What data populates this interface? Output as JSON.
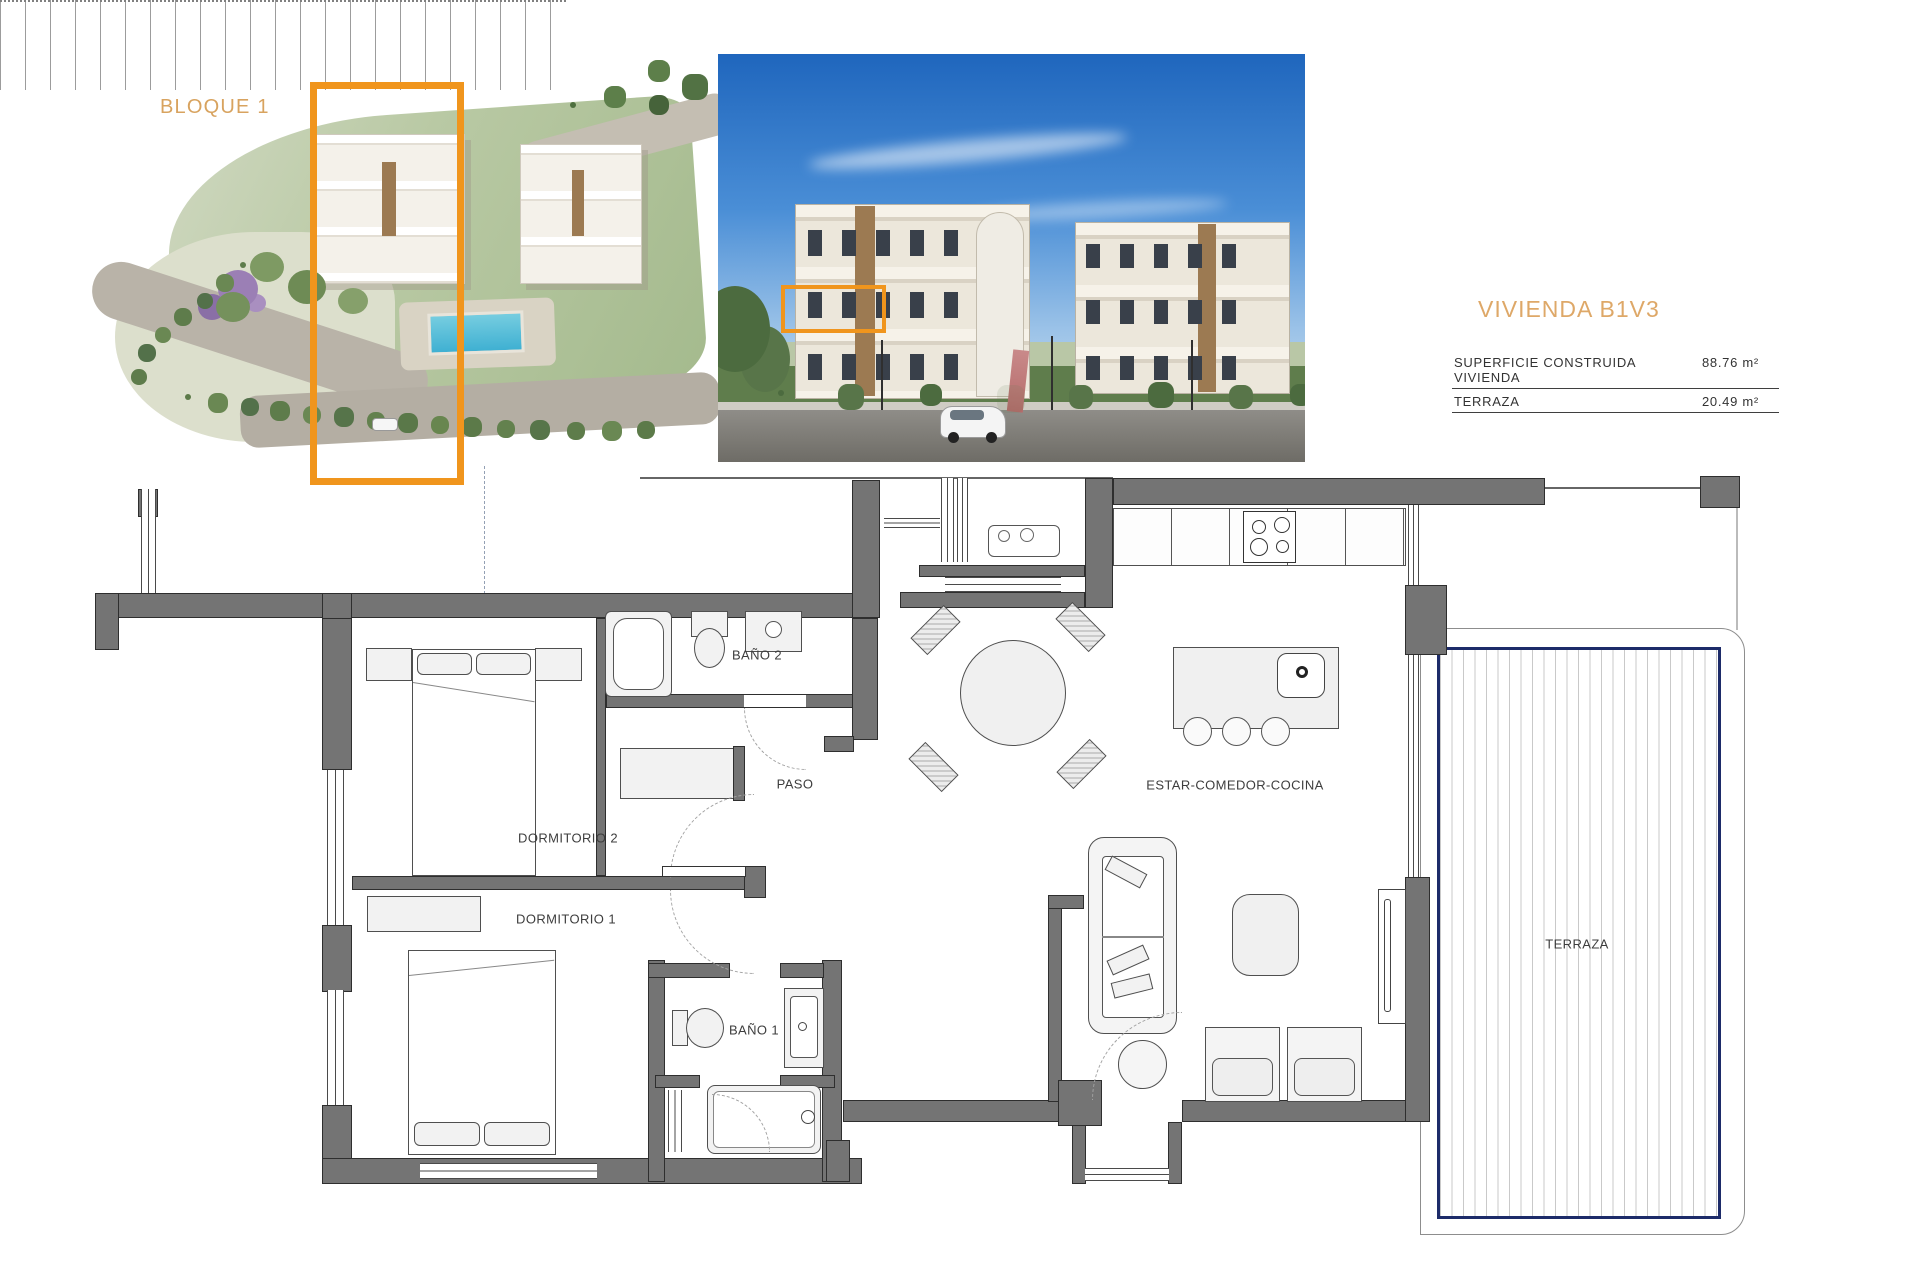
{
  "document": {
    "bloque_label": "BLOQUE 1",
    "unit_title": "VIVIENDA B1V3",
    "specs": [
      {
        "label": "SUPERFICIE CONSTRUIDA VIVIENDA",
        "value": "88.76 m²"
      },
      {
        "label": "TERRAZA",
        "value": "20.49 m²"
      }
    ],
    "rooms": {
      "bano2": "BAÑO 2",
      "paso": "PASO",
      "dorm2": "DORMITORIO 2",
      "dorm1": "DORMITORIO 1",
      "bano1": "BAÑO 1",
      "estar": "ESTAR-COMEDOR-COCINA",
      "terraza": "TERRAZA"
    },
    "colors": {
      "accent_orange": "#F0951D",
      "label_orange": "#D8A35F",
      "title_orange": "#DEA868",
      "wall_gray": "#747474",
      "terrace_navy": "#1D2B69"
    }
  }
}
